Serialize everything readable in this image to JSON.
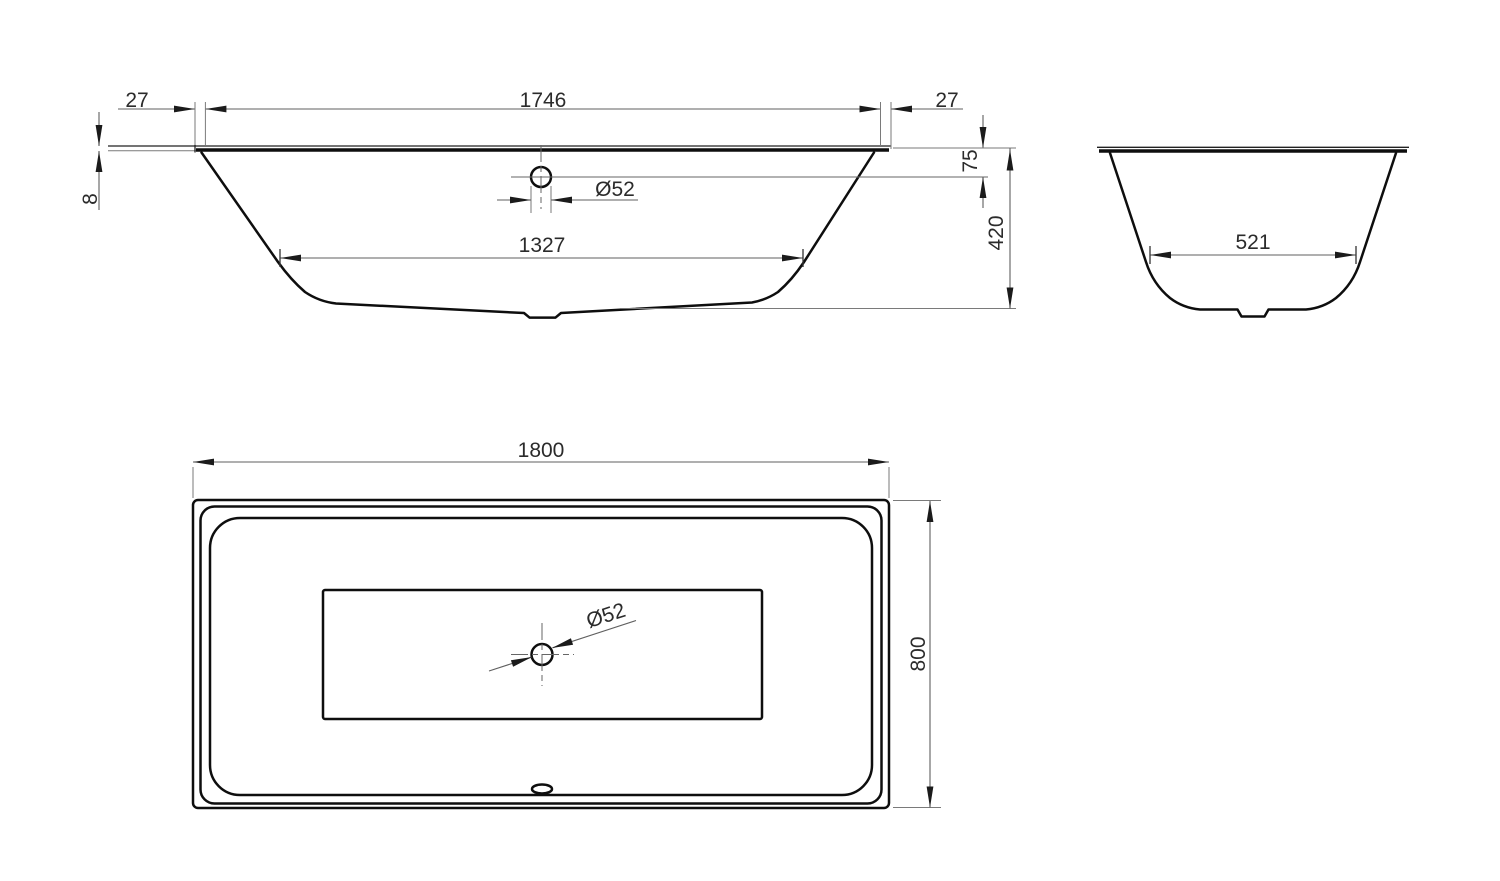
{
  "drawing": {
    "type": "bathtub-technical-drawing",
    "colors": {
      "background": "#ffffff",
      "object_line": "#0e0e0e",
      "dimension_line": "#5f5f5f",
      "text": "#2b2b2b"
    },
    "dims": {
      "side": {
        "offset_left": "27",
        "flange_length": "1746",
        "offset_right": "27",
        "rim_thickness": "8",
        "drain_diameter": "Ø52",
        "rim_to_drain": "75",
        "height": "420",
        "bottom_length": "1327"
      },
      "end": {
        "bottom_width": "521"
      },
      "plan": {
        "length": "1800",
        "width": "800",
        "drain_diameter": "Ø52"
      }
    }
  }
}
